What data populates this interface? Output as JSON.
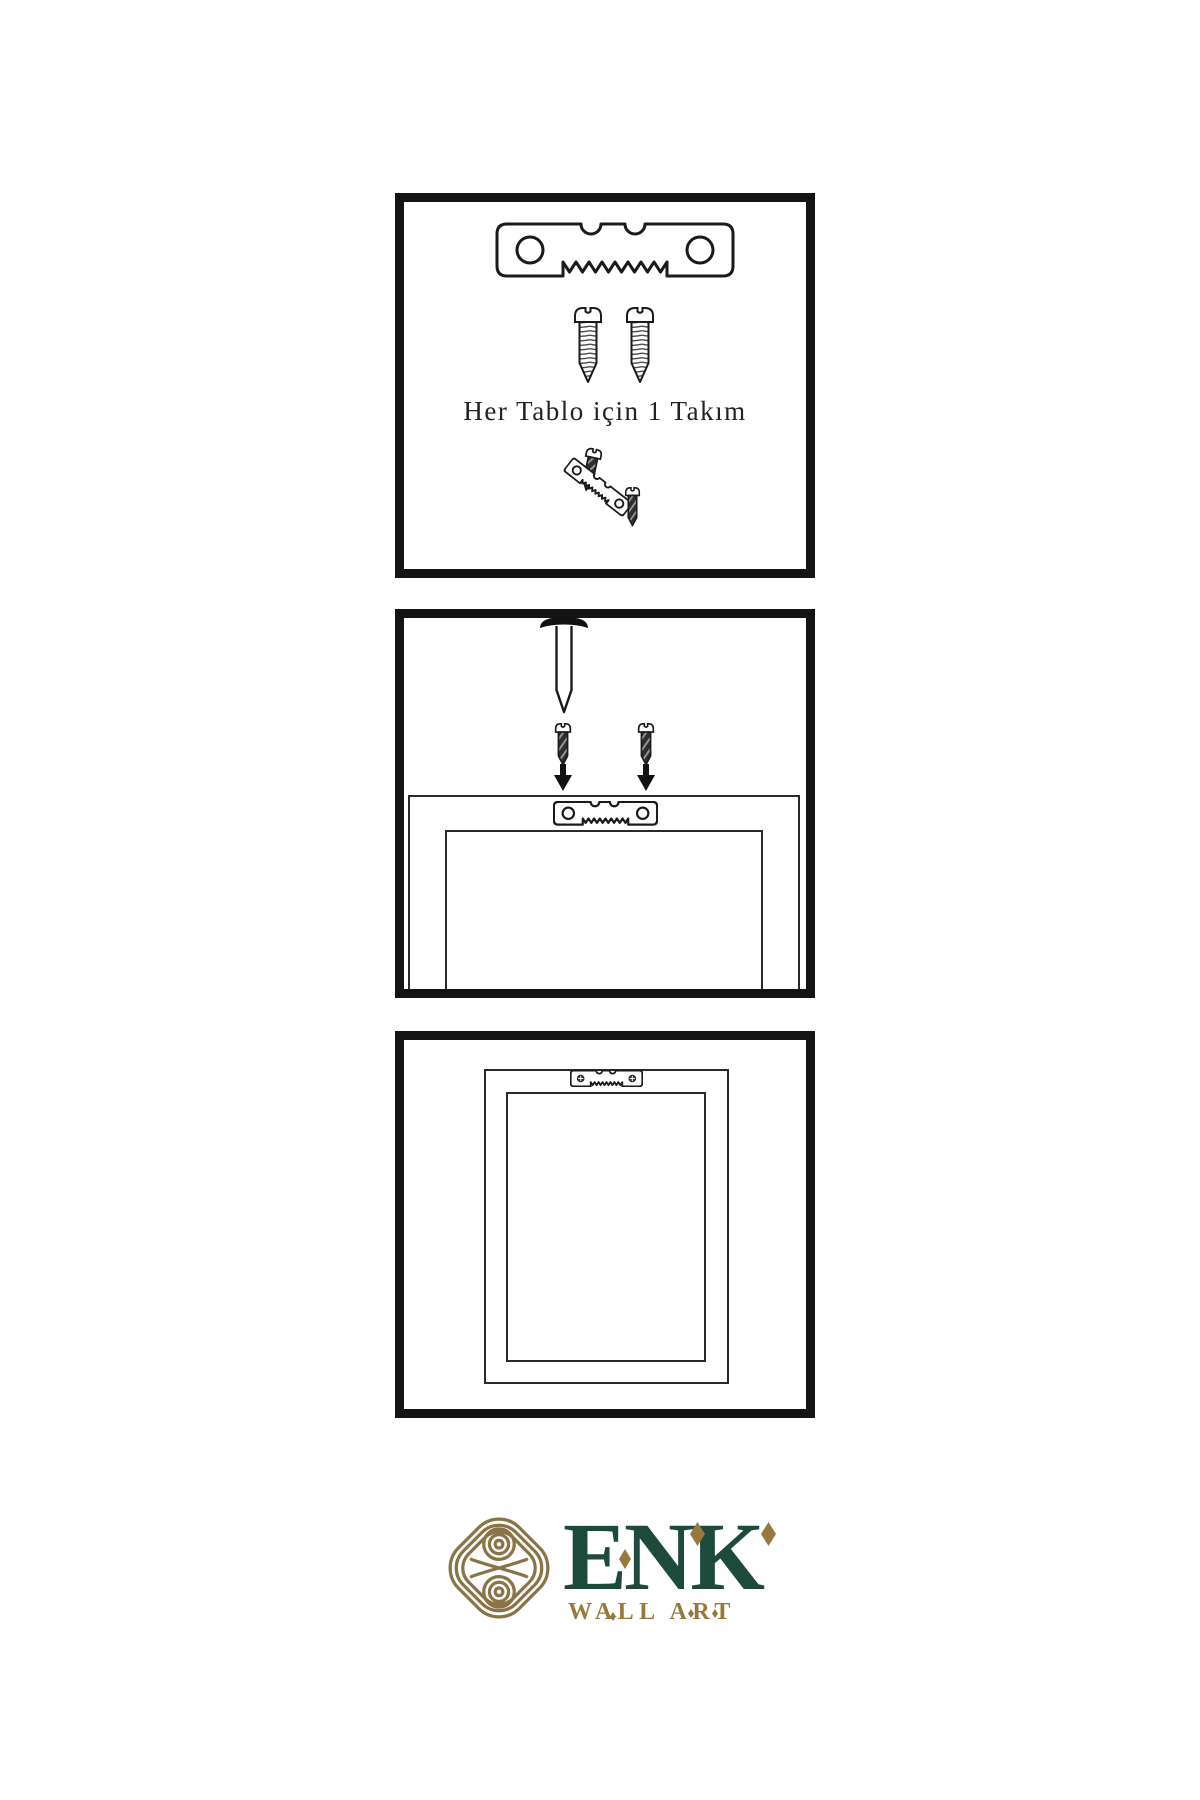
{
  "step1": {
    "caption": "Her Tablo için 1 Takım"
  },
  "brand": {
    "name": "ENK",
    "tagline": "WALL ART"
  },
  "colors": {
    "line": "#1a1a1a",
    "panel_border": "#141414",
    "brand_green": "#1d4a3c",
    "brand_gold": "#97793f",
    "knot_gold": "#8a7347",
    "screw_dark": "#2e2e2e"
  },
  "icons": {
    "sawtooth_hanger": "svg-shape",
    "screw_outline": "svg-shape",
    "screw_dark": "svg-shape",
    "wall_nail": "svg-shape",
    "arrow_down": "svg-shape",
    "knot_logo": "svg-shape",
    "diamond_ornament": "css-diamond"
  }
}
